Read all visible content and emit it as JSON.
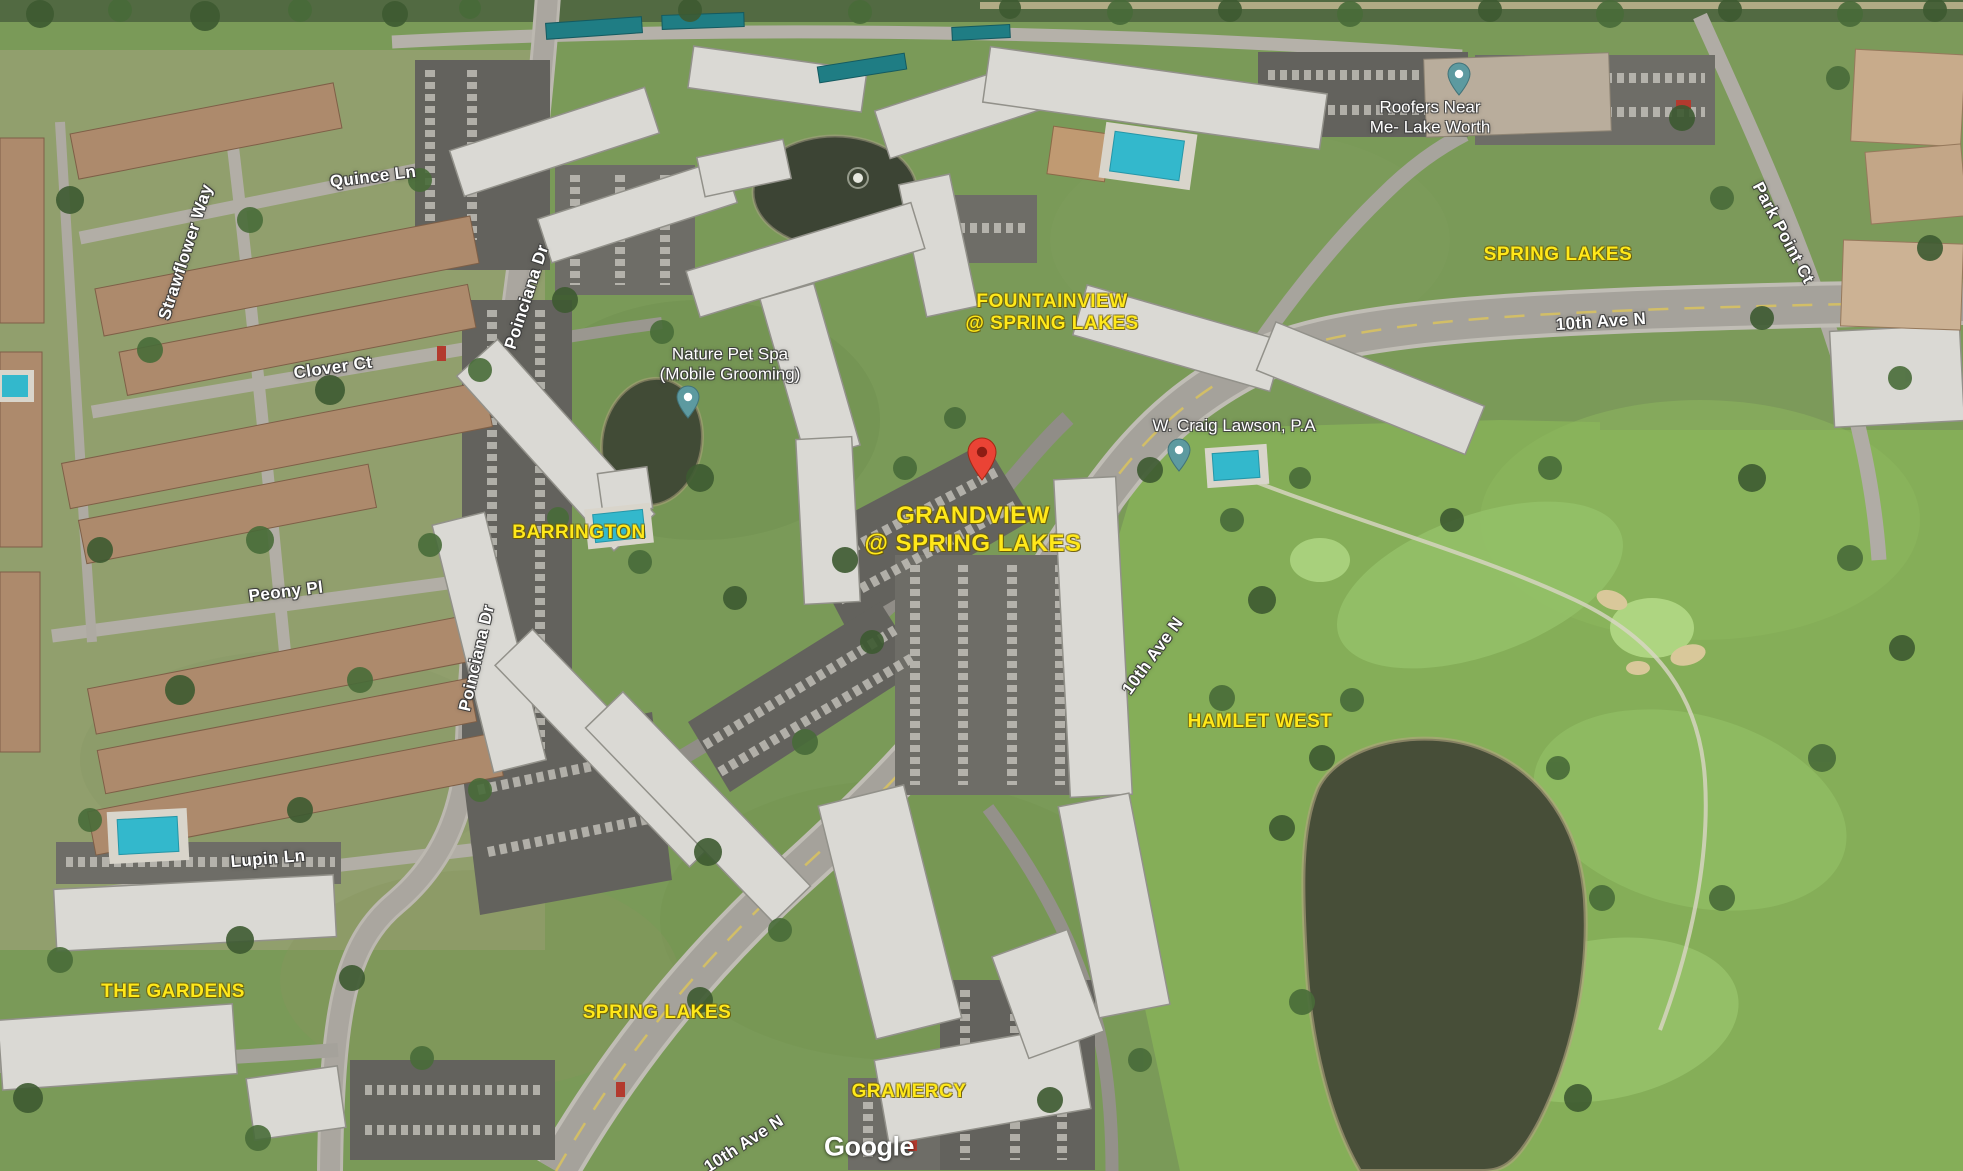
{
  "map": {
    "view_type": "satellite",
    "attribution": "Google",
    "street_labels": [
      {
        "text": "Quince Ln"
      },
      {
        "text": "Strawflower Way"
      },
      {
        "text": "Clover Ct"
      },
      {
        "text": "Poinciana Dr"
      },
      {
        "text": "Peony Pl"
      },
      {
        "text": "Poinciana Dr"
      },
      {
        "text": "Lupin Ln"
      },
      {
        "text": "10th Ave N"
      },
      {
        "text": "Park Point Ct"
      },
      {
        "text": "10th Ave N"
      },
      {
        "text": "10th Ave N"
      }
    ],
    "community_labels": [
      {
        "line1": "FOUNTAINVIEW",
        "line2": "@ SPRING LAKES"
      },
      {
        "line1": "GRANDVIEW",
        "line2": "@ SPRING LAKES"
      },
      {
        "text": "BARRINGTON"
      },
      {
        "text": "SPRING LAKES"
      },
      {
        "text": "HAMLET WEST"
      },
      {
        "text": "THE GARDENS"
      },
      {
        "text": "SPRING LAKES"
      },
      {
        "text": "GRAMERCY"
      }
    ],
    "poi_markers": [
      {
        "line1": "Nature Pet Spa",
        "line2": "(Mobile Grooming)"
      },
      {
        "name": "W. Craig Lawson, P.A"
      },
      {
        "line1": "Roofers Near",
        "line2": "Me- Lake Worth"
      }
    ],
    "colors": {
      "label_yellow": "#ffe81a",
      "pin_red": "#ea4335",
      "pin_teal": "#5d9aa0",
      "street_label_white": "#ffffff"
    }
  }
}
